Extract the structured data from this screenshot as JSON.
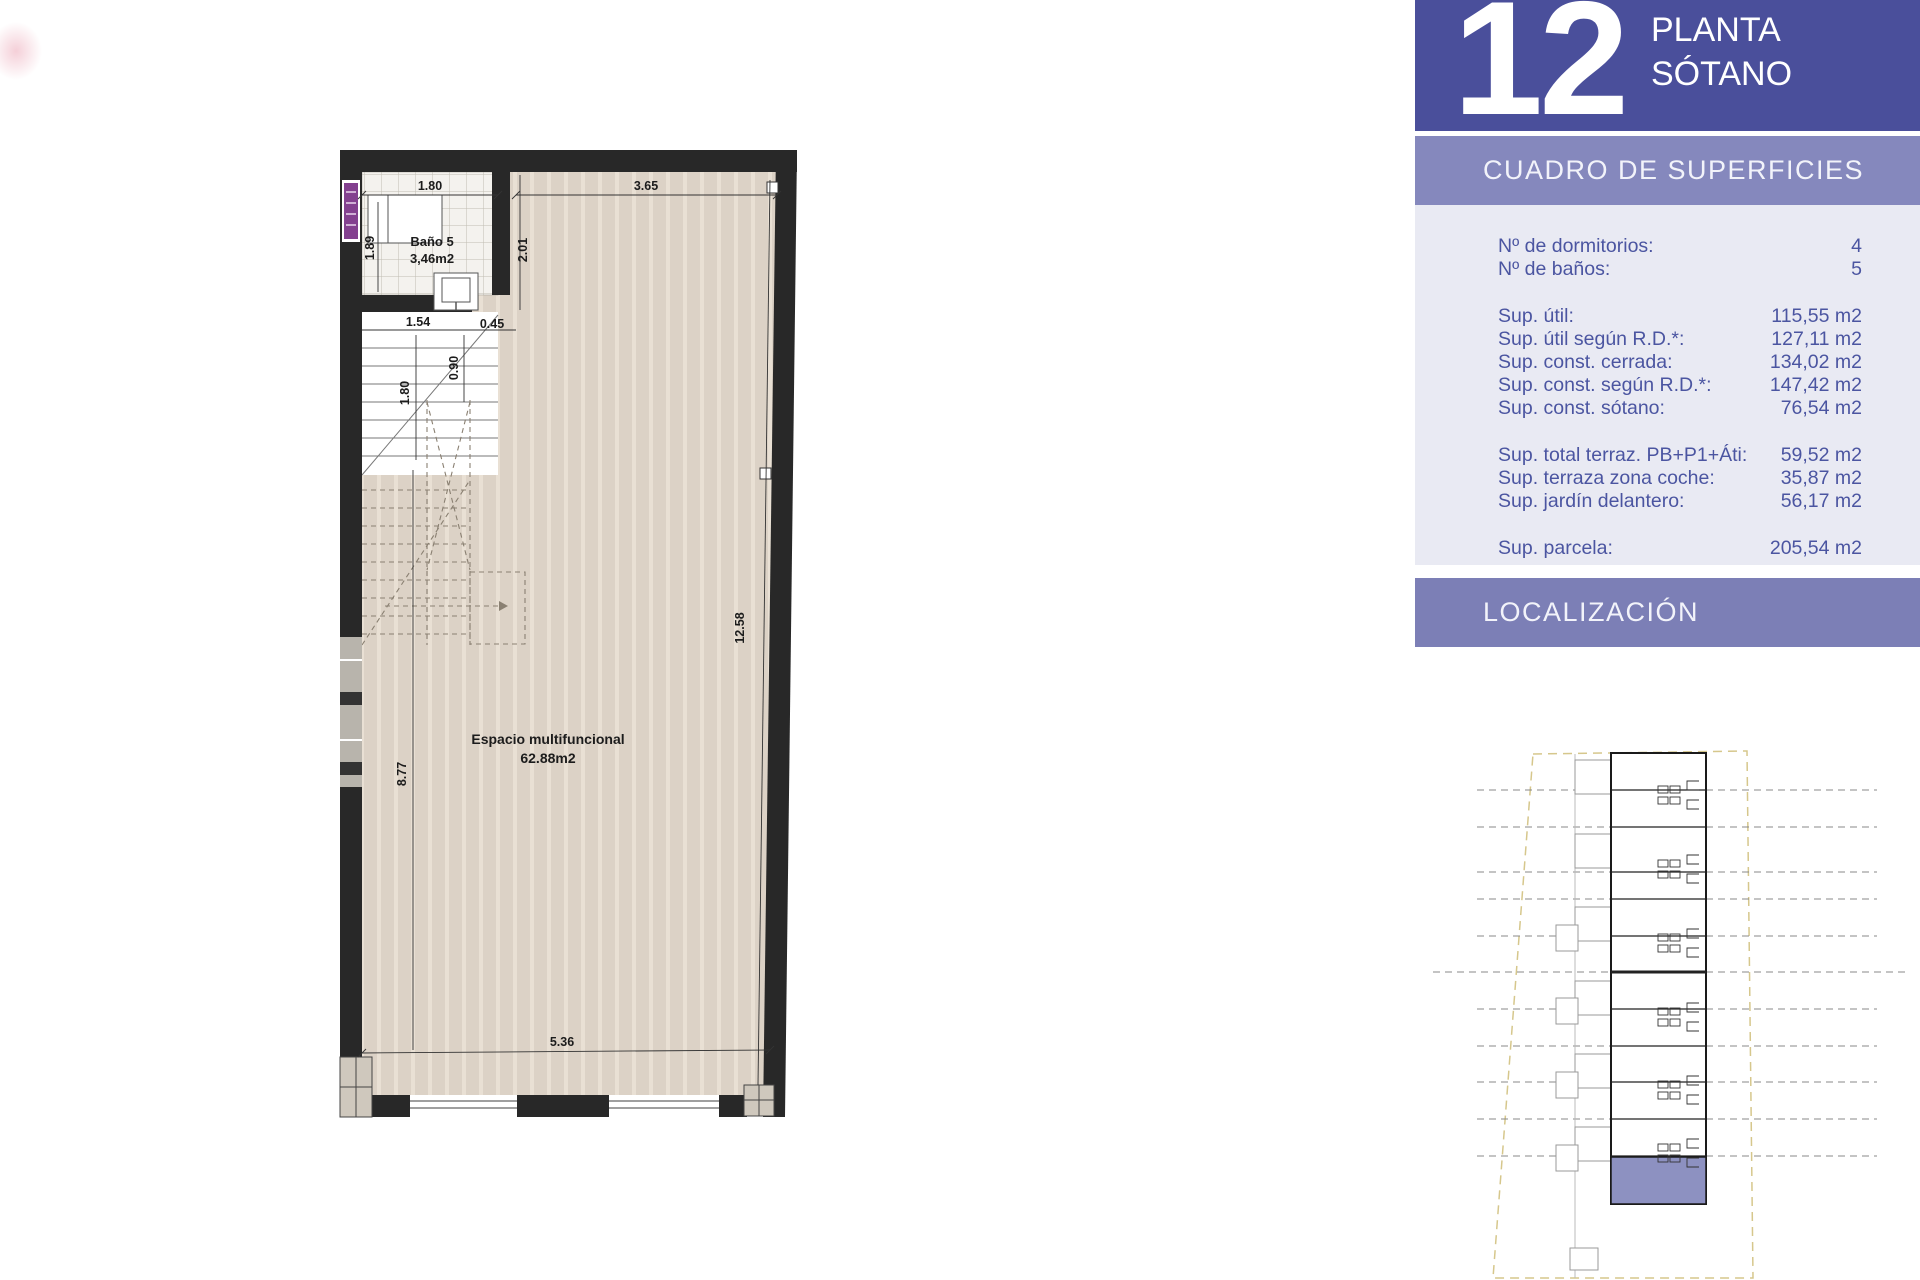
{
  "unit_header": {
    "number": "12",
    "plant_line1": "PLANTA",
    "plant_line2": "SÓTANO"
  },
  "surfaces": {
    "title": "CUADRO DE SUPERFICIES",
    "groups": [
      {
        "rows": [
          {
            "label": "Nº de dormitorios:",
            "value": "4"
          },
          {
            "label": "Nº de baños:",
            "value": "5"
          }
        ]
      },
      {
        "rows": [
          {
            "label": "Sup. útil:",
            "value": "115,55 m2"
          },
          {
            "label": "Sup. útil según R.D.*:",
            "value": "127,11 m2"
          },
          {
            "label": "Sup. const. cerrada:",
            "value": "134,02 m2"
          },
          {
            "label": "Sup. const. según R.D.*:",
            "value": "147,42 m2"
          },
          {
            "label": "Sup. const. sótano:",
            "value": "76,54 m2"
          }
        ]
      },
      {
        "rows": [
          {
            "label": "Sup. total terraz. PB+P1+Áti:",
            "value": "59,52 m2"
          },
          {
            "label": "Sup. terraza zona coche:",
            "value": "35,87 m2"
          },
          {
            "label": "Sup. jardín delantero:",
            "value": "56,17 m2"
          }
        ]
      },
      {
        "rows": [
          {
            "label": "Sup. parcela:",
            "value": "205,54 m2"
          }
        ]
      }
    ]
  },
  "localization": {
    "title": "LOCALIZACIÓN"
  },
  "plan": {
    "bath_name": "Baño 5",
    "bath_area": "3,46m2",
    "main_name": "Espacio multifuncional",
    "main_area": "62.88m2",
    "dims": {
      "top_left": "1.80",
      "top_right": "3.65",
      "bath_left": "1.89",
      "bath_right": "2.01",
      "below_bath_left": "1.54",
      "below_bath_right": "0.45",
      "stair_width": "0.90",
      "stair_left": "1.80",
      "left_height": "8.77",
      "right_height": "12.58",
      "bottom_width": "5.36"
    }
  },
  "colors": {
    "header_blue": "#4a4f9b",
    "band_blue": "#8588bd",
    "panel_bg": "#e9eaf3",
    "text_blue": "#4b55a1",
    "loc_band": "#7c7fb6",
    "floor_beige": "#dcd2c6",
    "unit_highlight": "#8d91c1",
    "door_marker_purple": "#83408f"
  }
}
